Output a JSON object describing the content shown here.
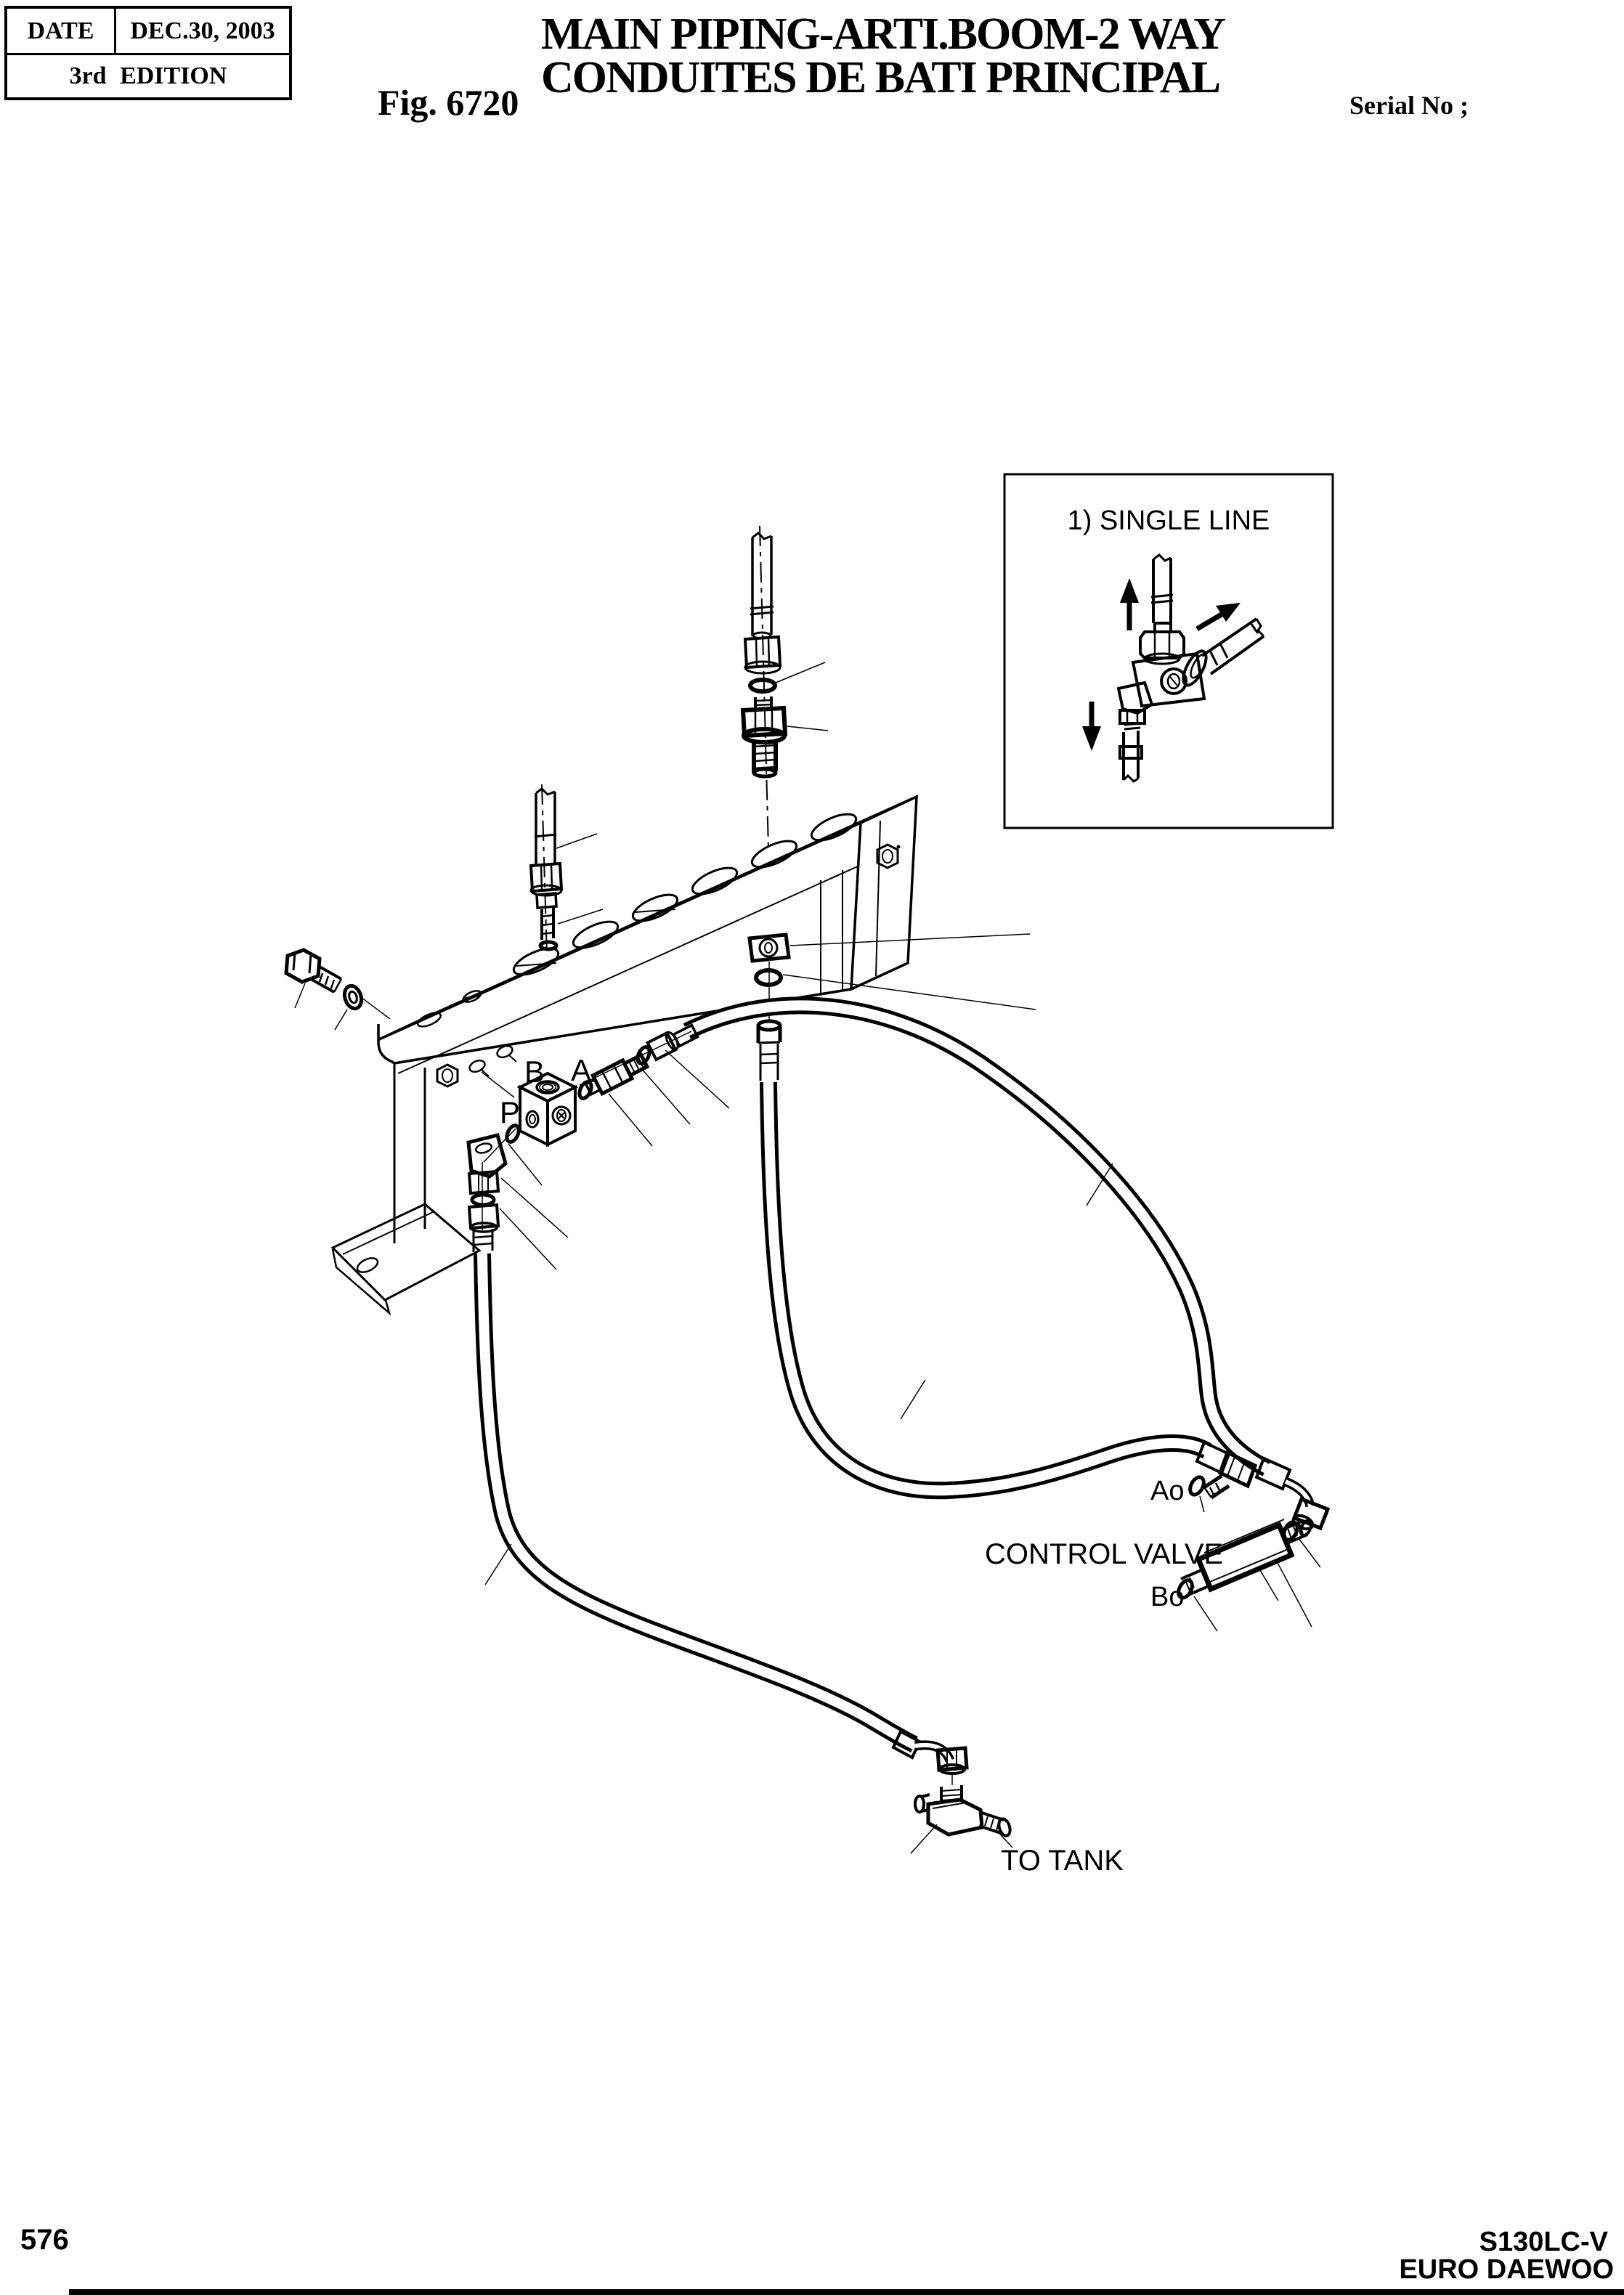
{
  "page": {
    "revision_table": {
      "date_label": "DATE",
      "date_value": "DEC.30, 2003",
      "edition": "3rd EDITION"
    },
    "figure": {
      "label": "Fig. 6720",
      "title_line1": "MAIN PIPING-ARTI.BOOM-2 WAY",
      "title_line2": "CONDUITES DE BATI PRINCIPAL",
      "serial_label": "Serial No ;"
    },
    "inset": {
      "caption": "1) SINGLE LINE"
    },
    "diagram_labels": {
      "port_b": "B",
      "port_a": "A",
      "port_p": "P",
      "port_ao": "Ao",
      "port_bo": "Bo",
      "control_valve": "CONTROL VALVE",
      "to_tank": "TO TANK"
    },
    "footer": {
      "page_number": "576",
      "model": "S130LC-V",
      "brand": "EURO DAEWOO"
    }
  },
  "colors": {
    "ink": "#000000",
    "paper": "#ffffff"
  }
}
